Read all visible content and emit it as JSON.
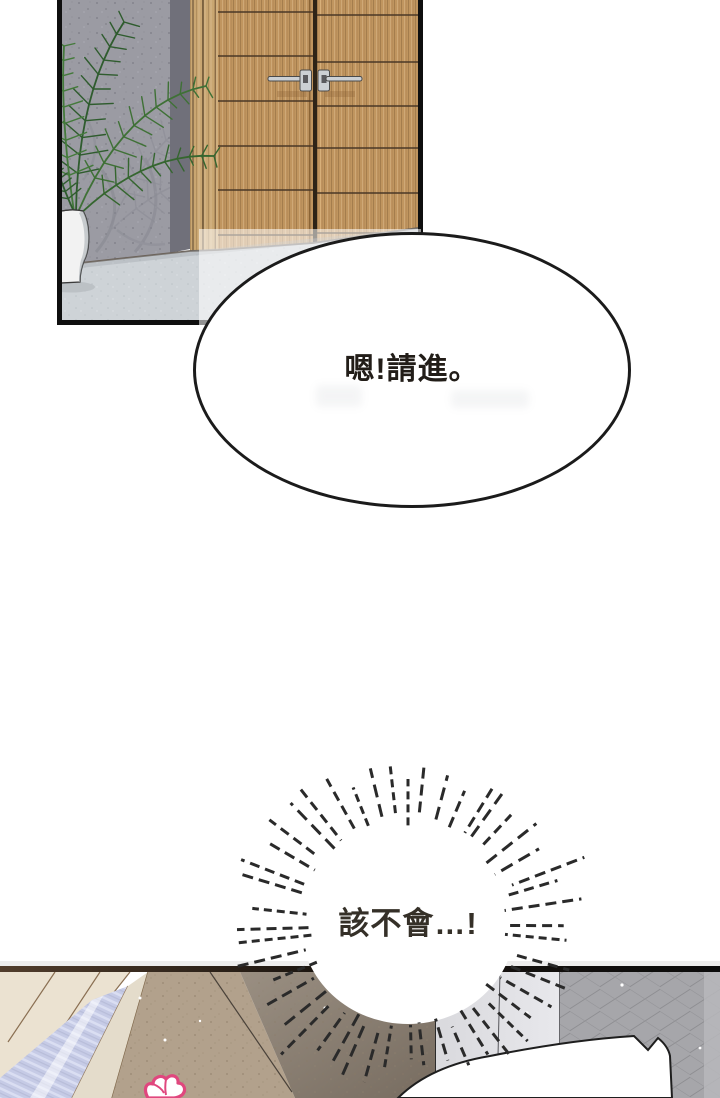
{
  "page": {
    "width": 720,
    "height": 1098,
    "background": "#ffffff"
  },
  "bubbles": {
    "oval": {
      "text": "嗯!請進。"
    },
    "burst": {
      "text": "該不會…!"
    }
  },
  "colors": {
    "page_bg": "#ffffff",
    "panel_border": "#0f0f0f",
    "bubble_outline": "#1b1b1b",
    "text_ink": "#221d18",
    "door_wood": "#c0955f",
    "door_frame_wood": "#c9a671",
    "door_groove": "#4a3826",
    "stone_wall": "#9b9ba3",
    "stone_wall_side": "#70707a",
    "floor_tile": "#ced3d7",
    "leaf_green_dark": "#2f5c2e",
    "leaf_green_mid": "#3f7136",
    "pot_white": "#f2f2f2",
    "handle_silver": "#ccd0d4",
    "ray_ink": "#2a2a2a",
    "tan_wall": "#b2a18c",
    "dark_wall": "#8a7f73",
    "gray_wall": "#a6a6aa",
    "light_panel": "#dedee2",
    "window_lavender": "#c6cbe6",
    "cream_wall": "#ebe2d1",
    "accent_pink": "#e0477e"
  },
  "burst": {
    "ray_count": 48,
    "center_x": 408,
    "center_y": 925
  }
}
